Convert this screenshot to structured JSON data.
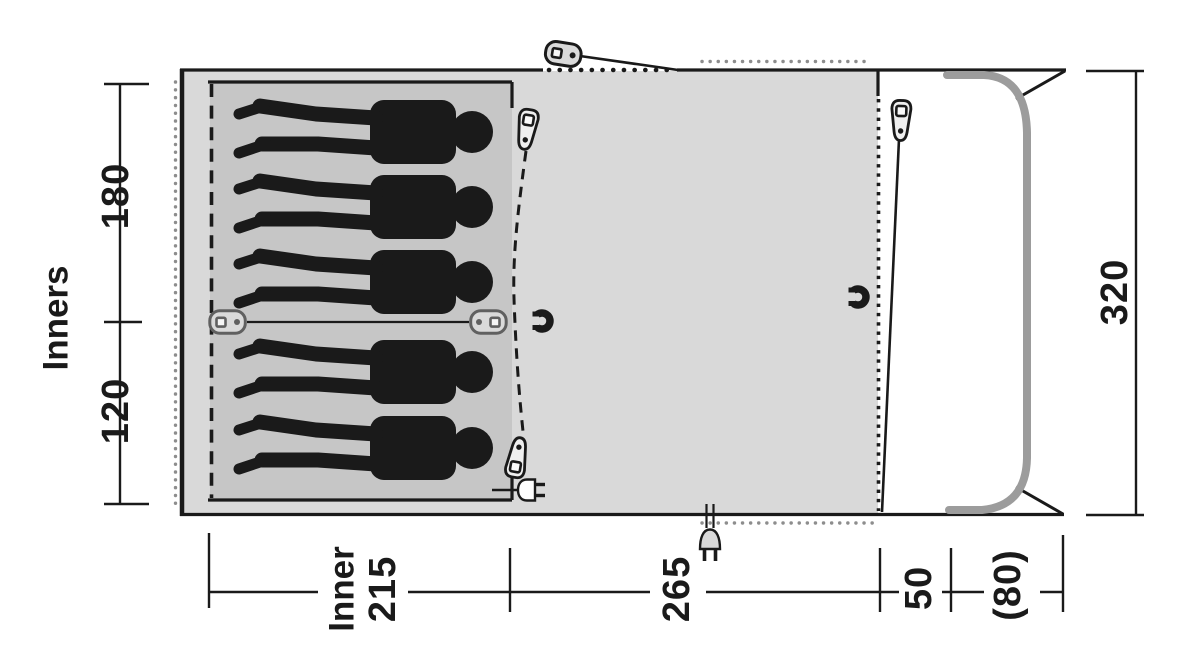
{
  "title": "Tent floor plan with dimensions",
  "labels": {
    "side_axis": "Inners",
    "inner_word": "Inner",
    "inner_width": "215",
    "bedroom_large": "180",
    "bedroom_small": "120",
    "living_width": "265",
    "front_strip": "50",
    "canopy": "(80)",
    "total_depth": "320"
  },
  "measurements_cm": {
    "bedroom_large_depth": 180,
    "bedroom_small_depth": 120,
    "inner_width": 215,
    "living_width": 265,
    "front_strip_width": 50,
    "canopy_width": 80,
    "total_depth": 320
  },
  "occupant_count": 5,
  "icons": [
    "guyline-toggle-icon",
    "zipper-pull-icon",
    "magnet-closure-icon",
    "tieback-toggle-icon",
    "power-inlet-plug-icon",
    "front-pole"
  ],
  "colors": {
    "outline": "#1a1a1a",
    "living_area": "#d9d9d9",
    "inner_area": "#c6c6c6",
    "pole": "#9c9c9c",
    "dots": "#8d8d8d"
  }
}
